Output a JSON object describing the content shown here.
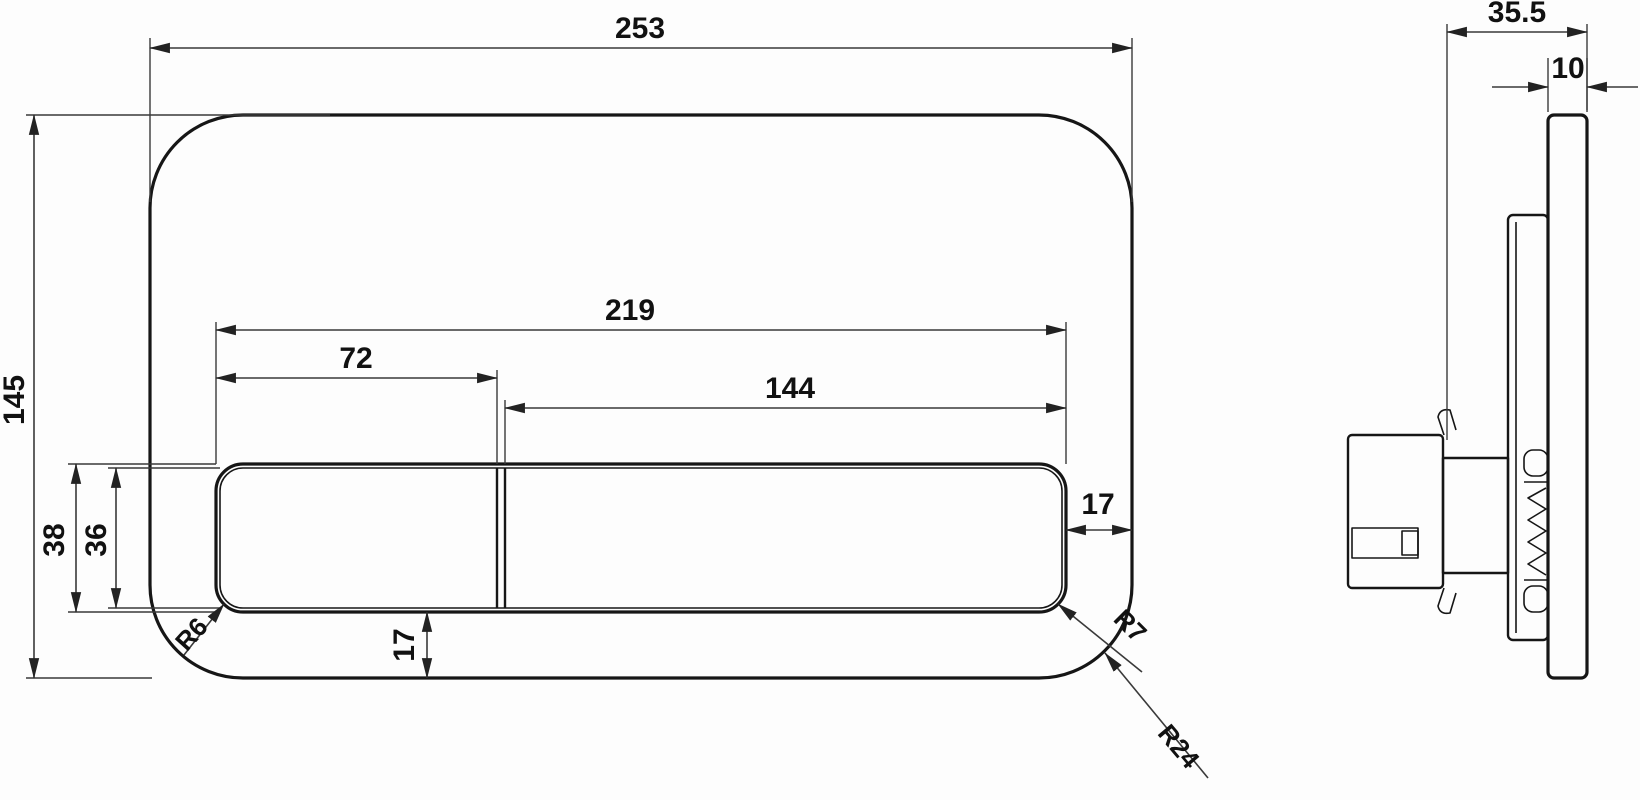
{
  "dimensions": {
    "front": {
      "overall_width": "253",
      "overall_height": "145",
      "button_area_width": "219",
      "small_button_width": "72",
      "large_button_width": "144",
      "button_area_height": "38",
      "button_inner_height": "36",
      "right_margin": "17",
      "bottom_margin": "17",
      "button_corner_radius": "R6",
      "button_area_corner_radius": "R7",
      "plate_corner_radius": "R24"
    },
    "side": {
      "overall_depth": "35.5",
      "plate_thickness": "10"
    }
  }
}
